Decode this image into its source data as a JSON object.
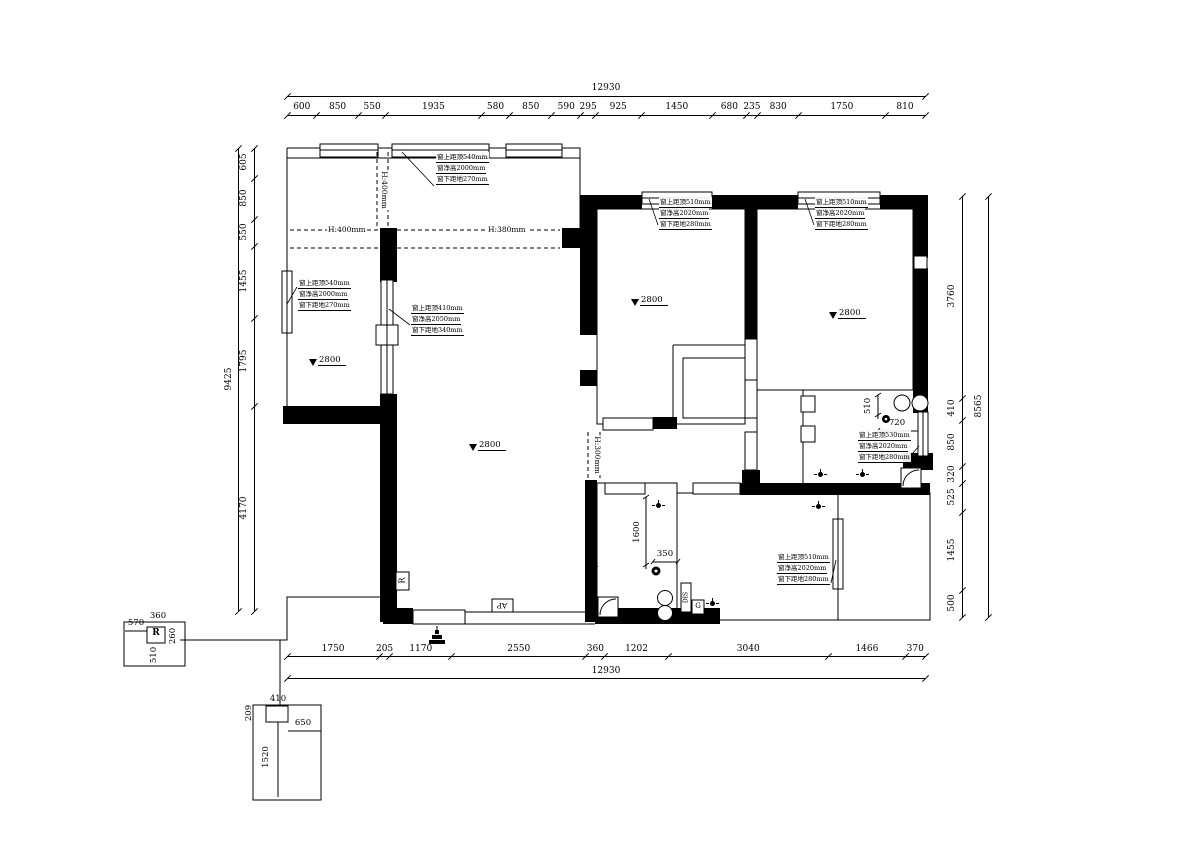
{
  "dims": {
    "top": {
      "total": "12930",
      "values": [
        "600",
        "850",
        "550",
        "1935",
        "580",
        "850",
        "590",
        "295",
        "925",
        "1450",
        "680",
        "235",
        "830",
        "1750",
        "810"
      ]
    },
    "bottom": {
      "total": "12930",
      "values": [
        "1750",
        "205",
        "1170",
        "2550",
        "360",
        "1202",
        "3040",
        "1466",
        "370"
      ]
    },
    "left": {
      "total": "9425",
      "values": [
        "605",
        "850",
        "550",
        "1455",
        "1795",
        "4170"
      ]
    },
    "right": {
      "total": "8565",
      "values": [
        "3760",
        "410",
        "850",
        "320",
        "525",
        "1455",
        "500"
      ]
    }
  },
  "height_labels": {
    "balcony_left": "H:400mm",
    "balcony_divider": "H:400mm",
    "balcony_right": "H:380mm",
    "passage": "H:300mm"
  },
  "window_notes": {
    "balcony_top": [
      "窗上距顶540mm",
      "窗净高2000mm",
      "窗下距地270mm"
    ],
    "left_room": [
      "窗上距顶540mm",
      "窗净高2000mm",
      "窗下距地270mm"
    ],
    "living_internal": [
      "窗上距顶410mm",
      "窗净高2050mm",
      "窗下距地340mm"
    ],
    "middle_bedroom": [
      "窗上距顶510mm",
      "窗净高2020mm",
      "窗下距地280mm"
    ],
    "right_bedroom": [
      "窗上距顶510mm",
      "窗净高2020mm",
      "窗下距地280mm"
    ],
    "bathroom": [
      "窗上距顶530mm",
      "窗净高2020mm",
      "窗下距地280mm"
    ],
    "lower_right_room": [
      "窗上距顶510mm",
      "窗净高2020mm",
      "窗下距地280mm"
    ]
  },
  "levels": [
    "2800",
    "2800",
    "2800",
    "2800"
  ],
  "local_dims": {
    "bath_v": "510",
    "bath_h": "720",
    "kitchen_v": "1600",
    "kitchen_h": "350",
    "rbox": {
      "top_left": "570",
      "top": "360",
      "right": "260",
      "bottom": "510",
      "label": "R"
    },
    "lower_detail": {
      "top": "410",
      "left": "209",
      "mid": "650",
      "vertical": "1520"
    }
  },
  "equipment": {
    "wall_r": "R",
    "ap": "AP",
    "drain": "DIS",
    "gas": "G"
  }
}
